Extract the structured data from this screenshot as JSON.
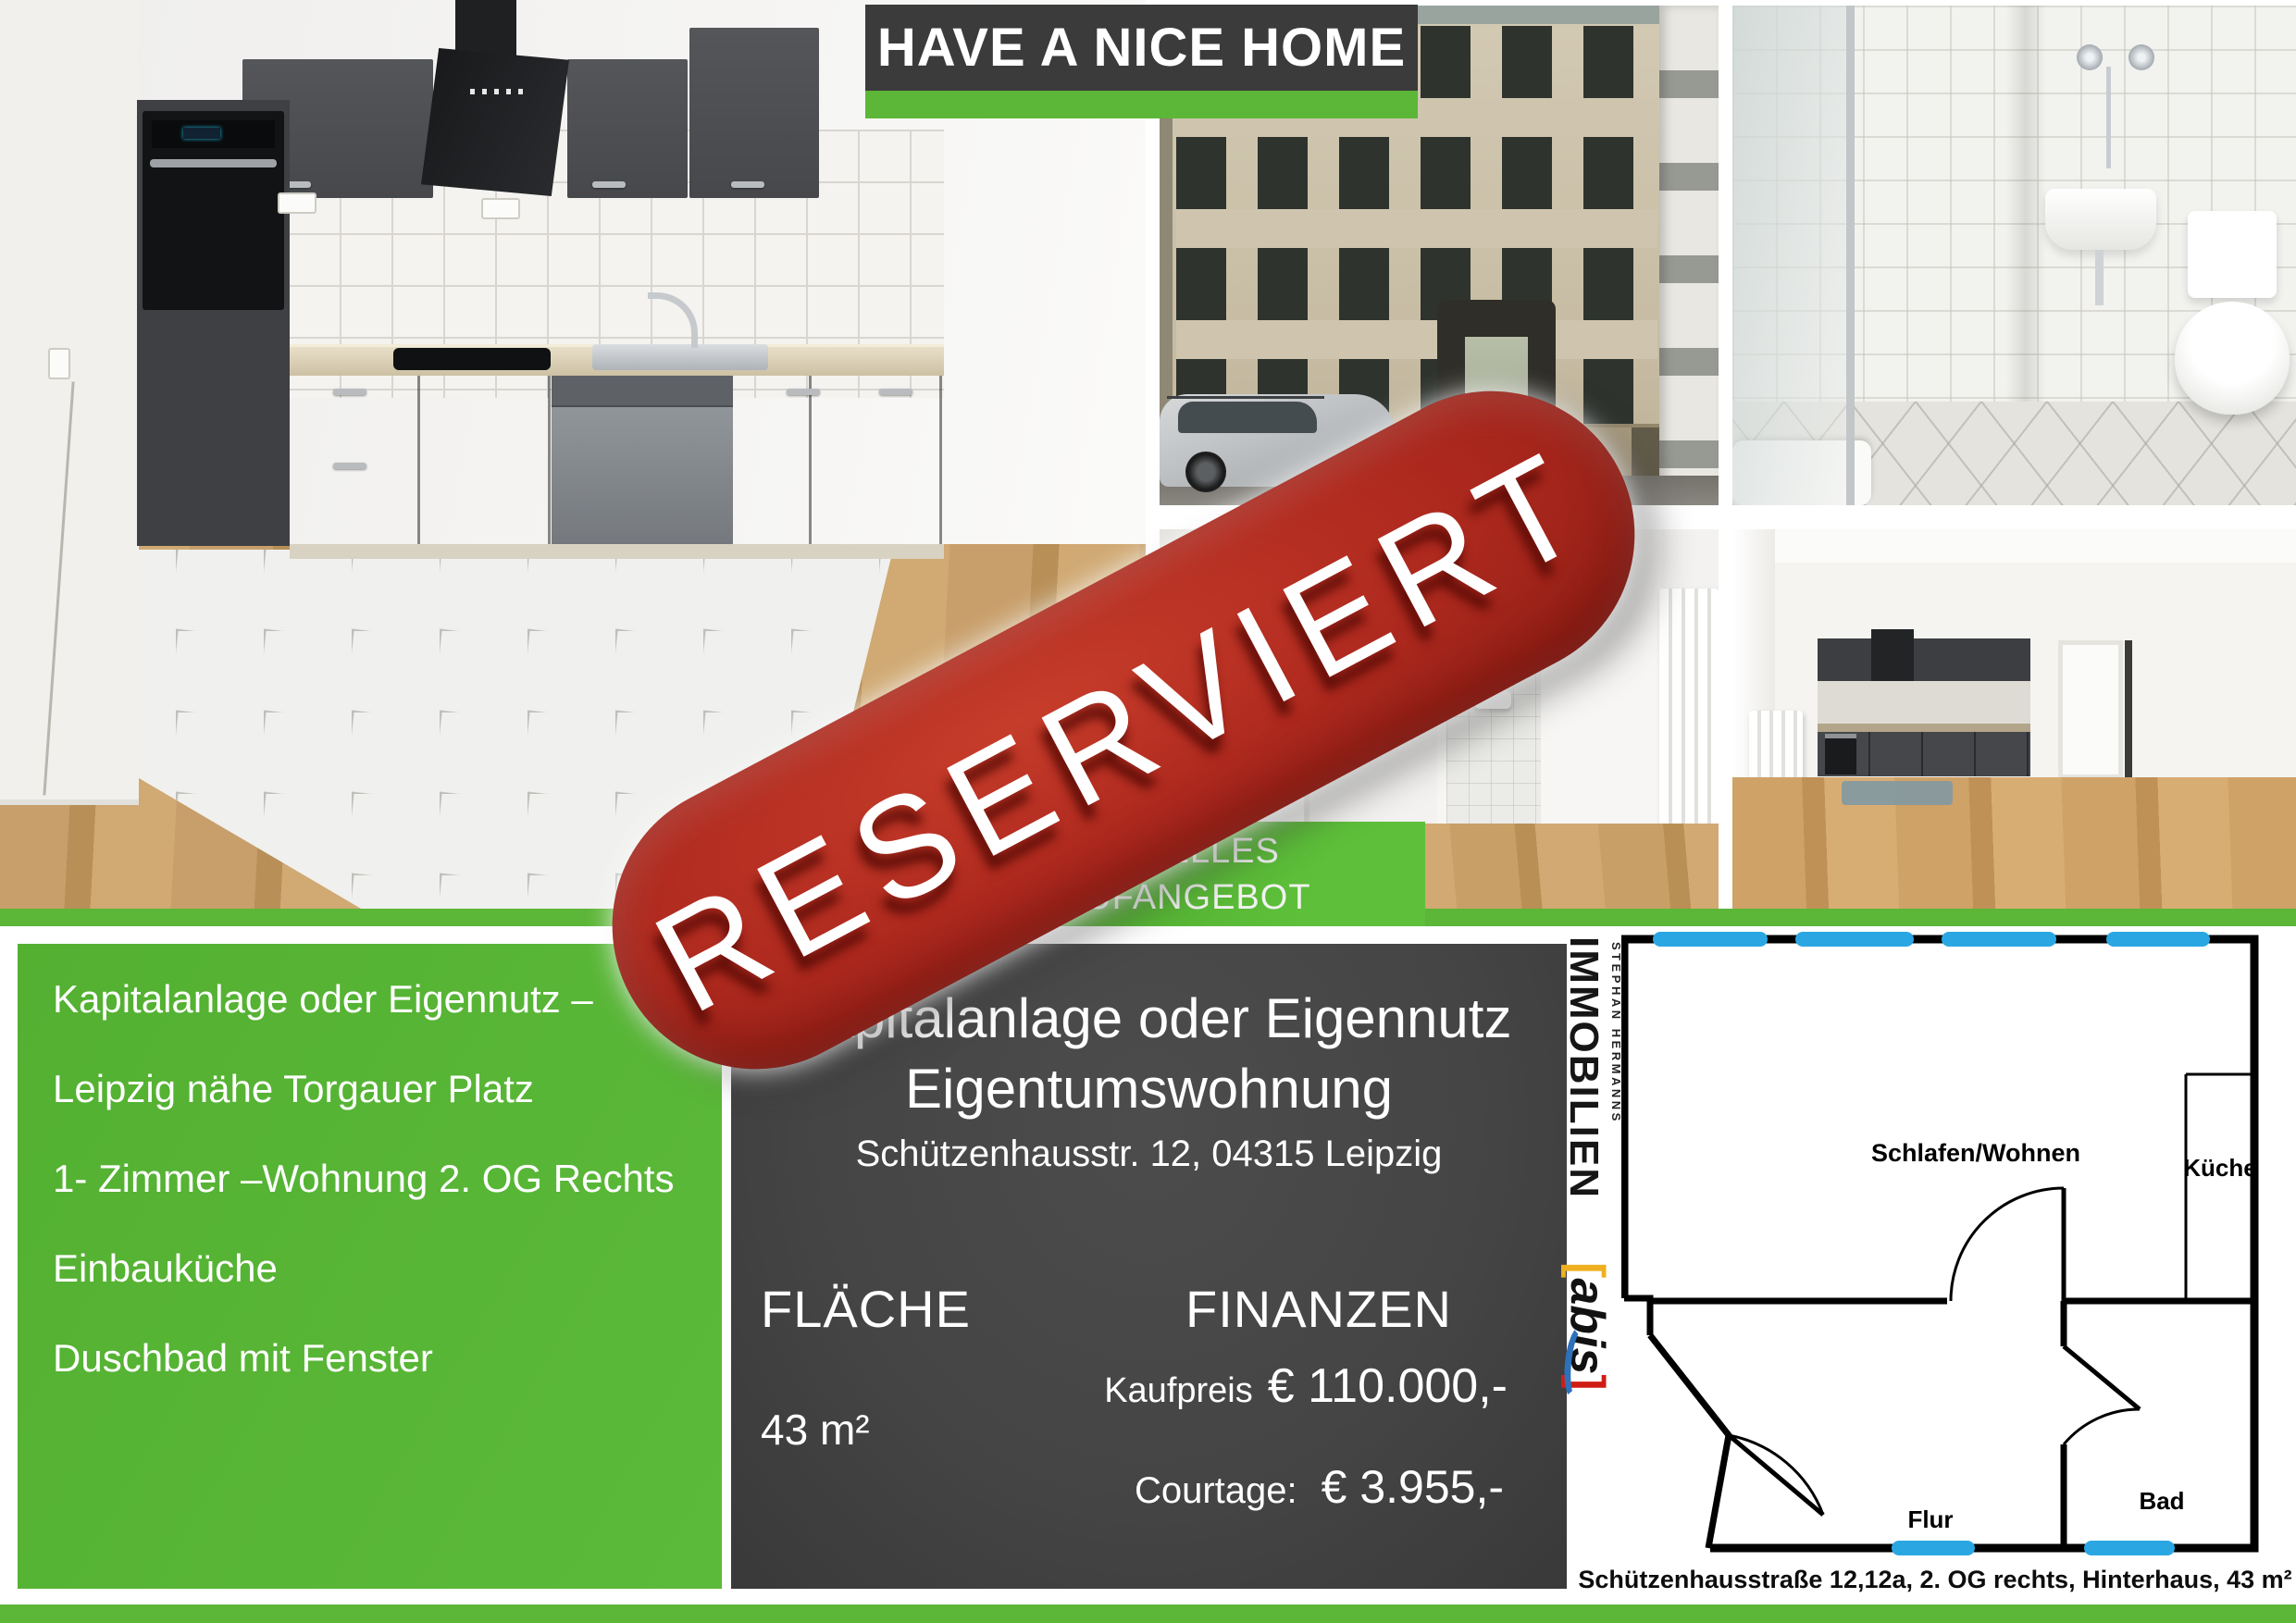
{
  "banner": {
    "title": "HAVE A NICE HOME"
  },
  "stamp": {
    "text": "RESERVIERT"
  },
  "offer_ribbon": {
    "line1": "AKTUELLES",
    "line2": "KAUFANGEBOT"
  },
  "features": {
    "items": [
      "Kapitalanlage oder Eigennutz –",
      "Leipzig nähe Torgauer Platz",
      "1- Zimmer –Wohnung 2. OG Rechts",
      "Einbauküche",
      "Duschbad mit Fenster"
    ]
  },
  "offer": {
    "title_line1": "Kapitalanlage oder Eigennutz",
    "title_line2": "Eigentumswohnung",
    "address": "Schützenhausstr. 12, 04315 Leipzig",
    "area_heading": "FLÄCHE",
    "area_value": "43 m²",
    "finance_heading": "FINANZEN",
    "price_label": "Kaufpreis",
    "price_value": "€ 110.000,-",
    "courtage_label": "Courtage:",
    "courtage_value": "€ 3.955,-"
  },
  "floorplan": {
    "rooms": {
      "living": "Schlafen/Wohnen",
      "kitchen": "Küche",
      "hall": "Flur",
      "bath": "Bad"
    },
    "caption": "Schützenhausstraße 12,12a, 2. OG rechts, Hinterhaus, 43 m²"
  },
  "logo": {
    "line1": "IMMOBILIEN",
    "line2": "STEPHAN HERMANNS",
    "bracket_left": "[",
    "brand": "abis",
    "bracket_right": "]"
  },
  "colors": {
    "green": "#5cb637",
    "dark_panel": "#454545",
    "stamp_red": "#b02a1f",
    "window_blue": "#2aa7e3"
  }
}
